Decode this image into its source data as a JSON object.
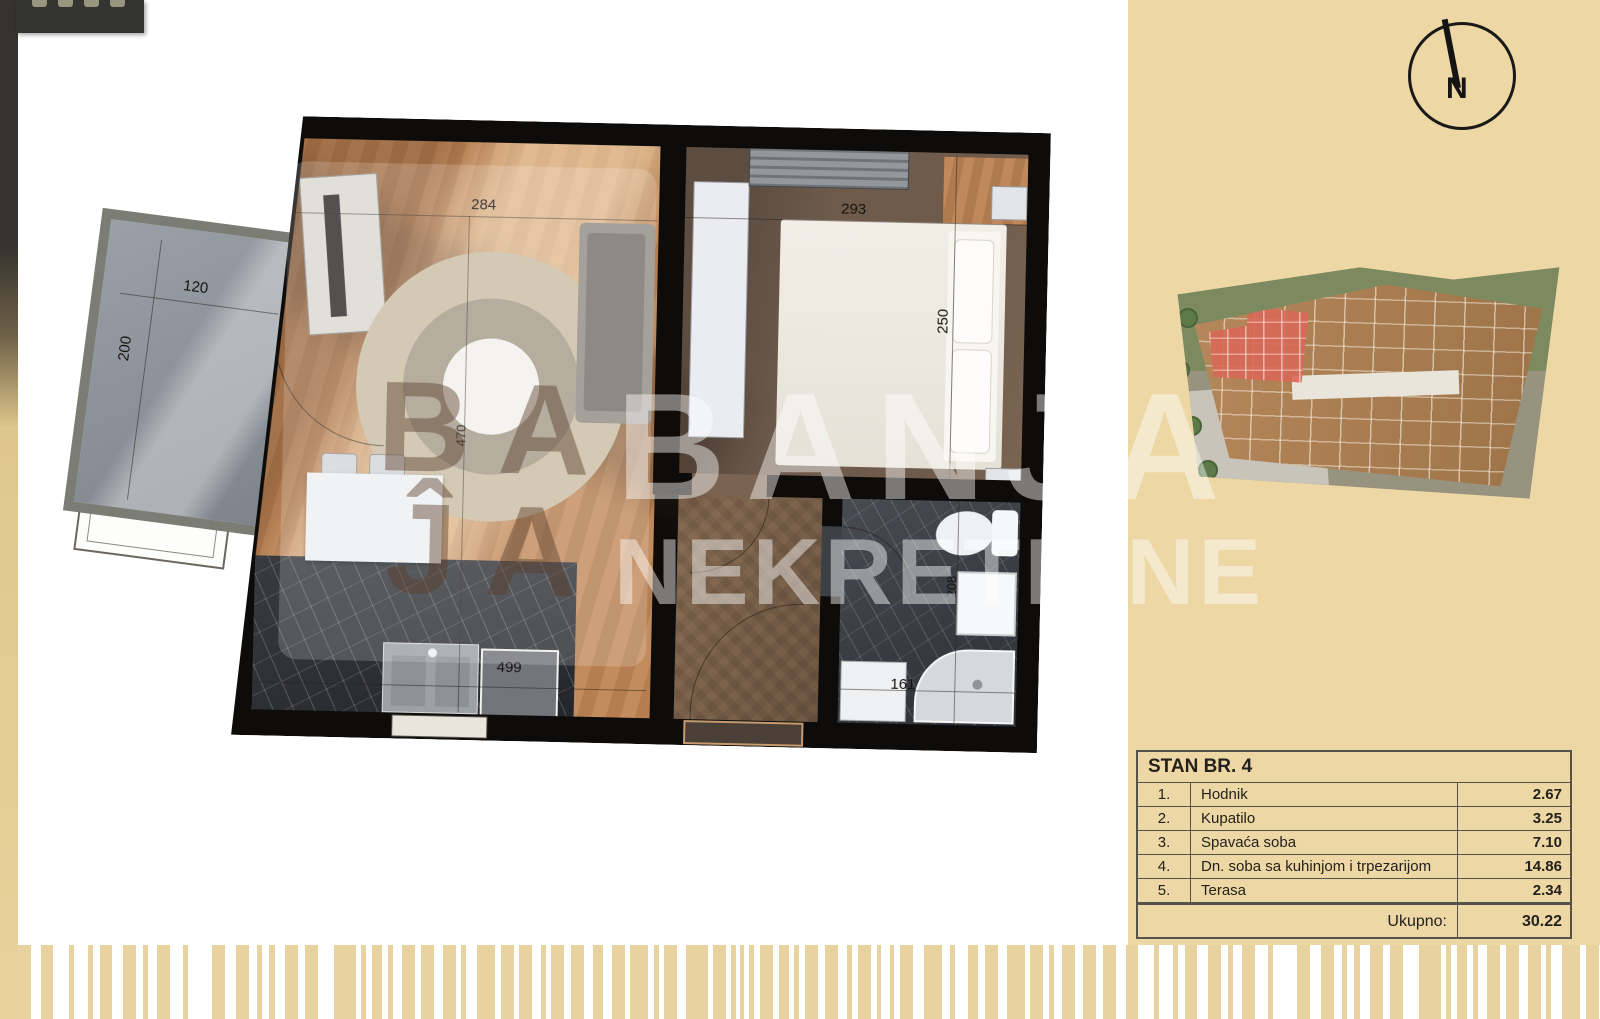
{
  "compass": {
    "label": "N"
  },
  "watermark": {
    "line1": "BANJA",
    "line2": "NEKRETNINE"
  },
  "logo": {
    "line1": "BA",
    "line2": "ĴA"
  },
  "dims": {
    "living_width": "284",
    "bedroom_width": "293",
    "bedroom_height": "250",
    "terrace_width": "120",
    "terrace_height": "200",
    "living_height": "470",
    "kitchen_width": "499",
    "bath_width": "161",
    "bath_height": "208"
  },
  "table": {
    "title": "STAN BR. 4",
    "rows": [
      {
        "num": "1.",
        "name": "Hodnik",
        "area": "2.67"
      },
      {
        "num": "2.",
        "name": "Kupatilo",
        "area": "3.25"
      },
      {
        "num": "3.",
        "name": "Spavaća soba",
        "area": "7.10"
      },
      {
        "num": "4.",
        "name": "Dn. soba sa kuhinjom i trpezarijom",
        "area": "14.86"
      },
      {
        "num": "5.",
        "name": "Terasa",
        "area": "2.34"
      }
    ],
    "total_label": "Ukupno:",
    "total_value": "30.22"
  },
  "colors": {
    "panel": "#ecd7a5",
    "bars": "#e8d2a0",
    "wall": "#0d0c0a",
    "highlight_unit": "#d86856"
  },
  "barcode": {
    "bars": [
      [
        13,
        10
      ],
      [
        12,
        16
      ],
      [
        5,
        14
      ],
      [
        5,
        7
      ],
      [
        12,
        11
      ],
      [
        13,
        7
      ],
      [
        5,
        9
      ],
      [
        13,
        13
      ],
      [
        5,
        24
      ],
      [
        13,
        11
      ],
      [
        13,
        8
      ],
      [
        5,
        7
      ],
      [
        6,
        10
      ],
      [
        13,
        7
      ],
      [
        13,
        16
      ],
      [
        22,
        5
      ],
      [
        5,
        6
      ],
      [
        10,
        6
      ],
      [
        5,
        9
      ],
      [
        13,
        6
      ],
      [
        13,
        9
      ],
      [
        13,
        5
      ],
      [
        5,
        11
      ],
      [
        18,
        6
      ],
      [
        13,
        5
      ],
      [
        13,
        9
      ],
      [
        5,
        5
      ],
      [
        13,
        7
      ],
      [
        13,
        9
      ],
      [
        10,
        9
      ],
      [
        13,
        5
      ],
      [
        18,
        6
      ],
      [
        5,
        5
      ],
      [
        13,
        9
      ],
      [
        22,
        5
      ],
      [
        13,
        5
      ],
      [
        5,
        4
      ],
      [
        4,
        5
      ],
      [
        5,
        6
      ],
      [
        13,
        6
      ],
      [
        10,
        5
      ],
      [
        5,
        6
      ],
      [
        13,
        7
      ],
      [
        13,
        9
      ],
      [
        5,
        6
      ],
      [
        13,
        6
      ],
      [
        4,
        9
      ],
      [
        4,
        6
      ],
      [
        13,
        11
      ],
      [
        18,
        8
      ],
      [
        5,
        13
      ],
      [
        10,
        7
      ],
      [
        13,
        9
      ],
      [
        18,
        5
      ],
      [
        13,
        6
      ],
      [
        5,
        8
      ],
      [
        13,
        8
      ],
      [
        13,
        7
      ]
    ]
  }
}
